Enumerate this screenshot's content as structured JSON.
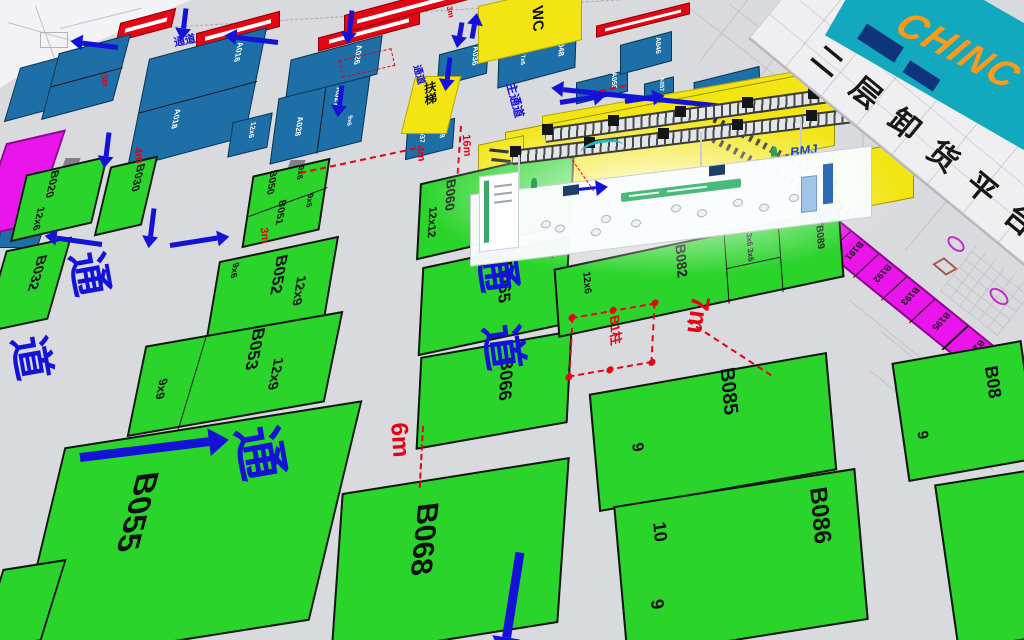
{
  "banner": {
    "platform": "二层卸货平台",
    "logo": "CHINC"
  },
  "fac": {
    "wc": "WC",
    "esc": "扶梯",
    "main": "主通道",
    "aisle": "通道",
    "tong": "通",
    "dao": "道",
    "col": "B1柱",
    "brand": "BMJ"
  },
  "dims": {
    "d3": "3m",
    "d4": "4m",
    "d6": "6m",
    "d7": "7m",
    "d16": "16m"
  },
  "booths": {
    "green": [
      {
        "label": "B020",
        "size": "12x6"
      },
      {
        "label": "B030"
      },
      {
        "label": "B032"
      },
      {
        "label": "B050",
        "size": "9x6"
      },
      {
        "label": "B051",
        "size": "9x6"
      },
      {
        "label": "B060",
        "size": "12x12"
      },
      {
        "label": "B052",
        "size": "12x9",
        "size2": "9x6"
      },
      {
        "label": "B053",
        "size": "12x9",
        "size2": "9x9"
      },
      {
        "label": "B065"
      },
      {
        "label": "B066"
      },
      {
        "label": "B055"
      },
      {
        "label": "B068"
      },
      {
        "label": "B082",
        "size": "12x6",
        "size2": "3x6 3x6"
      },
      {
        "label": "B087B089"
      },
      {
        "label": "B085",
        "size": "9"
      },
      {
        "label": "B086",
        "size": "10",
        "size2": "9"
      },
      {
        "label": "B08",
        "size": "9"
      }
    ],
    "blue": [
      "A016",
      "A018",
      "A026",
      "A027",
      "A028",
      "A036",
      "A037",
      "A038",
      "A046",
      "A048",
      "A055",
      "A057"
    ],
    "blue_sizes": [
      "12x6",
      "9x6",
      "7x6"
    ],
    "magenta": [
      "B190",
      "B191",
      "B192",
      "B193",
      "B195",
      "B196"
    ]
  }
}
